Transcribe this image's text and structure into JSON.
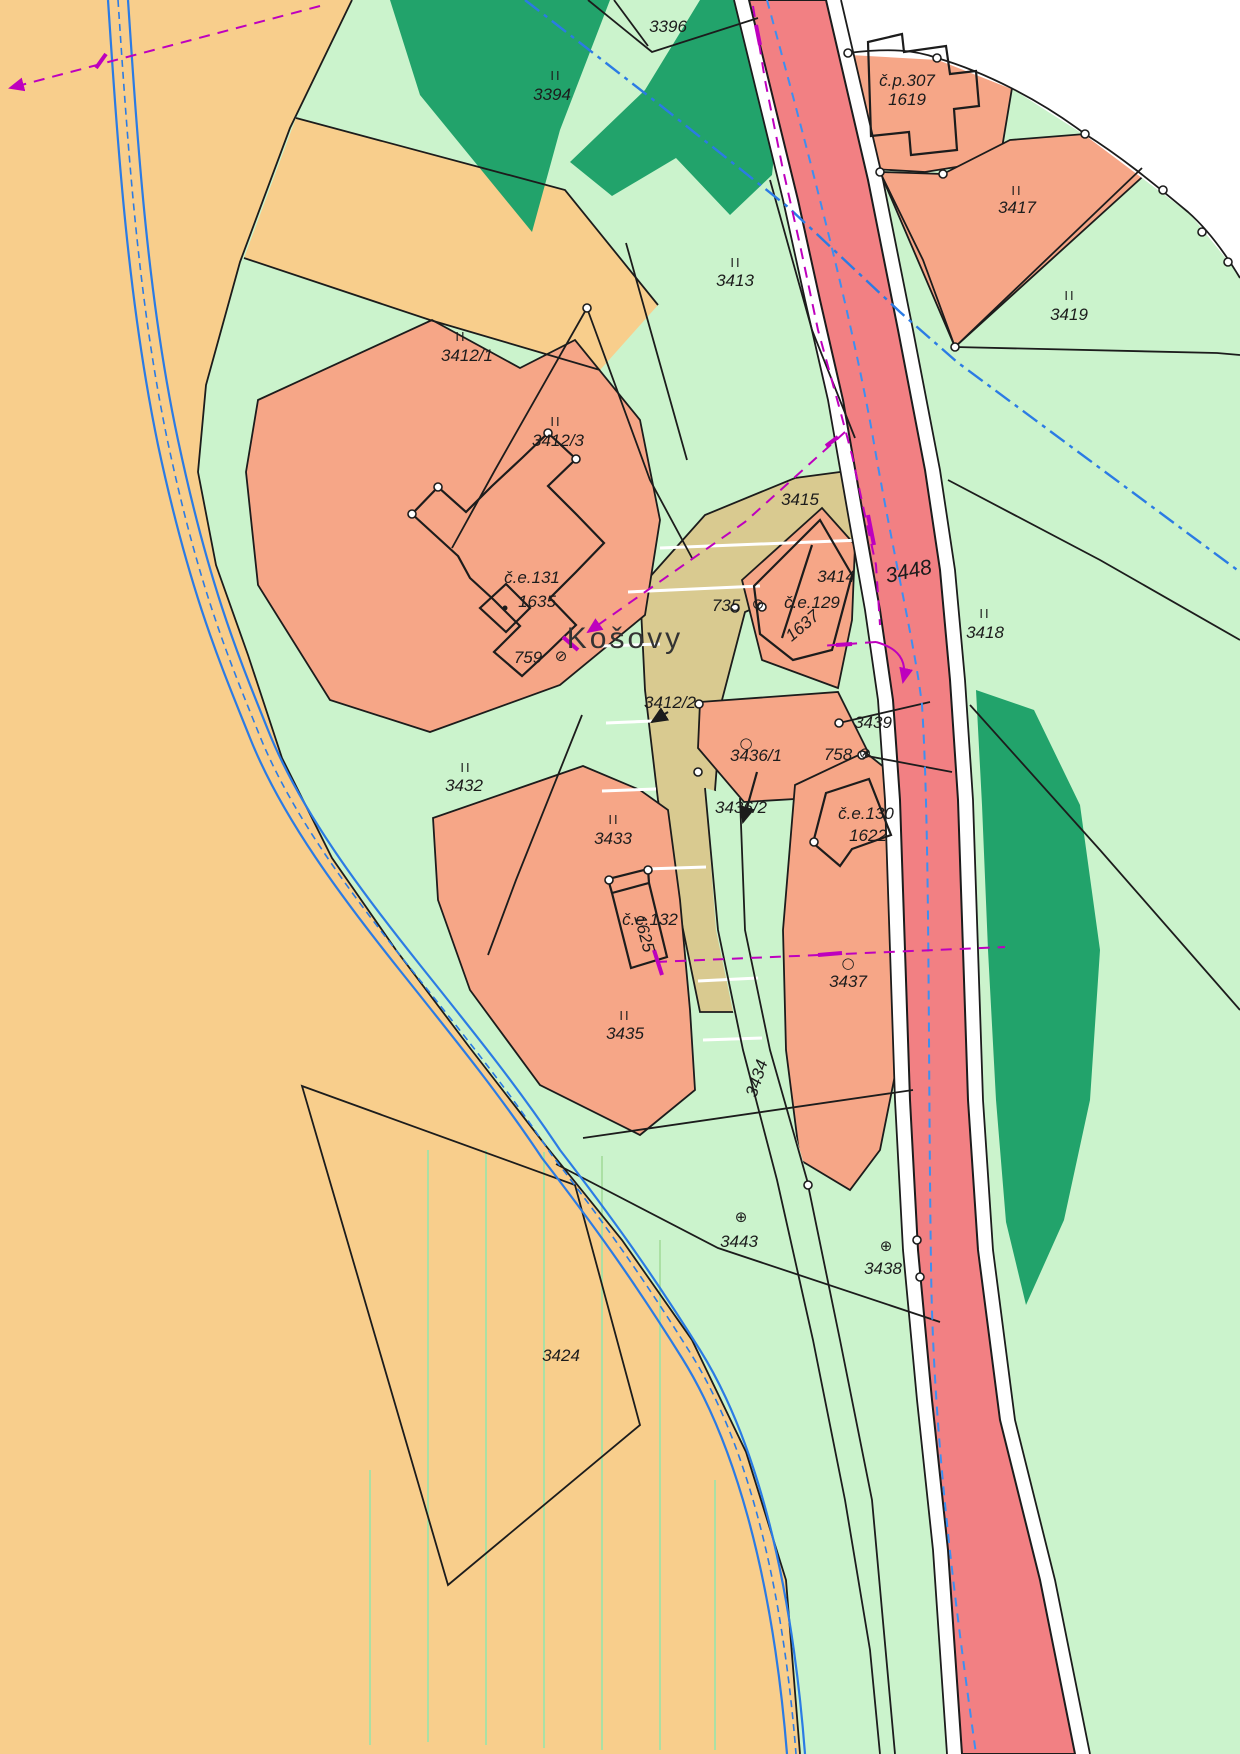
{
  "map": {
    "title": "Cadastral map",
    "place_name": "Košovy",
    "colors": {
      "field_orange": "#F8CE8C",
      "meadow_green": "#CBF3CC",
      "forest_green": "#22A36B",
      "built_salmon": "#F6A687",
      "road_red": "#F28083",
      "path_tan": "#D9CA90",
      "stream_blue": "#2B7BE4",
      "axis_blue": "#3E8FF0",
      "utility_magenta": "#BE00BE",
      "boundary_black": "#1c1c1c",
      "white": "#FFFFFF"
    },
    "labels": [
      {
        "name": "parcel-3396",
        "text": "3396",
        "x": 668,
        "y": 32,
        "cls": "num"
      },
      {
        "name": "class-ii-3394",
        "text": "II",
        "x": 556,
        "y": 80,
        "cls": "roman"
      },
      {
        "name": "parcel-3394",
        "text": "3394",
        "x": 552,
        "y": 100,
        "cls": "num"
      },
      {
        "name": "house-cp307",
        "text": "č.p.307",
        "x": 907,
        "y": 86,
        "cls": "num"
      },
      {
        "name": "parcel-1619",
        "text": "1619",
        "x": 907,
        "y": 105,
        "cls": "num"
      },
      {
        "name": "class-ii-3417",
        "text": "II",
        "x": 1017,
        "y": 195,
        "cls": "roman"
      },
      {
        "name": "parcel-3417",
        "text": "3417",
        "x": 1017,
        "y": 213,
        "cls": "num"
      },
      {
        "name": "class-ii-3419",
        "text": "II",
        "x": 1070,
        "y": 300,
        "cls": "roman"
      },
      {
        "name": "parcel-3419",
        "text": "3419",
        "x": 1069,
        "y": 320,
        "cls": "num"
      },
      {
        "name": "class-ii-3413",
        "text": "II",
        "x": 736,
        "y": 267,
        "cls": "roman"
      },
      {
        "name": "parcel-3413",
        "text": "3413",
        "x": 735,
        "y": 286,
        "cls": "num"
      },
      {
        "name": "class-ii-3412-1",
        "text": "II",
        "x": 461,
        "y": 341,
        "cls": "roman"
      },
      {
        "name": "parcel-3412-1",
        "text": "3412/1",
        "x": 467,
        "y": 361,
        "cls": "num"
      },
      {
        "name": "class-ii-3412-3",
        "text": "II",
        "x": 556,
        "y": 426,
        "cls": "roman"
      },
      {
        "name": "parcel-3412-3",
        "text": "3412/3",
        "x": 558,
        "y": 446,
        "cls": "num"
      },
      {
        "name": "parcel-3415",
        "text": "3415",
        "x": 800,
        "y": 505,
        "cls": "num"
      },
      {
        "name": "house-ce131",
        "text": "č.e.131",
        "x": 532,
        "y": 583,
        "cls": "num"
      },
      {
        "name": "parcel-1635",
        "text": "1635",
        "x": 537,
        "y": 607,
        "cls": "num"
      },
      {
        "name": "place-kosovy",
        "text": "Košovy",
        "x": 625,
        "y": 648,
        "cls": "place"
      },
      {
        "name": "parcel-759",
        "text": "759",
        "x": 528,
        "y": 663,
        "cls": "num"
      },
      {
        "name": "symbol-759",
        "text": "⊘",
        "x": 561,
        "y": 661,
        "cls": "sym"
      },
      {
        "name": "parcel-735",
        "text": "735",
        "x": 726,
        "y": 611,
        "cls": "num"
      },
      {
        "name": "symbol-735",
        "text": "⊘",
        "x": 758,
        "y": 609,
        "cls": "sym"
      },
      {
        "name": "parcel-3414",
        "text": "3414",
        "x": 836,
        "y": 582,
        "cls": "num"
      },
      {
        "name": "house-ce129",
        "text": "č.e.129",
        "x": 812,
        "y": 608,
        "cls": "num"
      },
      {
        "name": "parcel-1637",
        "text": "1637",
        "x": 806,
        "y": 630,
        "cls": "num",
        "rot": -40
      },
      {
        "name": "parcel-3448",
        "text": "3448",
        "x": 910,
        "y": 578,
        "cls": "num big",
        "rot": -12
      },
      {
        "name": "class-ii-3418",
        "text": "II",
        "x": 985,
        "y": 618,
        "cls": "roman"
      },
      {
        "name": "parcel-3418",
        "text": "3418",
        "x": 985,
        "y": 638,
        "cls": "num"
      },
      {
        "name": "parcel-3412-2",
        "text": "3412/2",
        "x": 670,
        "y": 708,
        "cls": "num"
      },
      {
        "name": "parcel-3439",
        "text": "3439",
        "x": 873,
        "y": 728,
        "cls": "num"
      },
      {
        "name": "symbol-3436-1",
        "text": "○",
        "x": 746,
        "y": 748,
        "cls": "sym"
      },
      {
        "name": "parcel-3436-1",
        "text": "3436/1",
        "x": 756,
        "y": 761,
        "cls": "num"
      },
      {
        "name": "parcel-758",
        "text": "758",
        "x": 838,
        "y": 760,
        "cls": "num"
      },
      {
        "name": "symbol-758",
        "text": "⊘",
        "x": 865,
        "y": 758,
        "cls": "sym"
      },
      {
        "name": "class-ii-3432",
        "text": "II",
        "x": 466,
        "y": 772,
        "cls": "roman"
      },
      {
        "name": "parcel-3432",
        "text": "3432",
        "x": 464,
        "y": 791,
        "cls": "num"
      },
      {
        "name": "parcel-3436-2",
        "text": "3436/2",
        "x": 741,
        "y": 813,
        "cls": "num"
      },
      {
        "name": "class-ii-3433",
        "text": "II",
        "x": 614,
        "y": 824,
        "cls": "roman"
      },
      {
        "name": "parcel-3433",
        "text": "3433",
        "x": 613,
        "y": 844,
        "cls": "num"
      },
      {
        "name": "house-ce130",
        "text": "č.e.130",
        "x": 866,
        "y": 819,
        "cls": "num"
      },
      {
        "name": "parcel-1622",
        "text": "1622",
        "x": 868,
        "y": 841,
        "cls": "num"
      },
      {
        "name": "house-ce132",
        "text": "č.e.132",
        "x": 650,
        "y": 925,
        "cls": "num"
      },
      {
        "name": "parcel-1625",
        "text": "1625",
        "x": 639,
        "y": 935,
        "cls": "num",
        "rot": 75
      },
      {
        "name": "symbol-3437",
        "text": "○",
        "x": 848,
        "y": 968,
        "cls": "sym"
      },
      {
        "name": "parcel-3437",
        "text": "3437",
        "x": 848,
        "y": 987,
        "cls": "num"
      },
      {
        "name": "class-ii-3435",
        "text": "II",
        "x": 625,
        "y": 1020,
        "cls": "roman"
      },
      {
        "name": "parcel-3435",
        "text": "3435",
        "x": 625,
        "y": 1039,
        "cls": "num"
      },
      {
        "name": "parcel-3434",
        "text": "3434",
        "x": 762,
        "y": 1080,
        "cls": "num",
        "rot": -72
      },
      {
        "name": "symbol-3443",
        "text": "⊕",
        "x": 741,
        "y": 1222,
        "cls": "sym"
      },
      {
        "name": "parcel-3443",
        "text": "3443",
        "x": 739,
        "y": 1247,
        "cls": "num"
      },
      {
        "name": "symbol-3438",
        "text": "⊕",
        "x": 886,
        "y": 1251,
        "cls": "sym"
      },
      {
        "name": "parcel-3438",
        "text": "3438",
        "x": 883,
        "y": 1274,
        "cls": "num"
      },
      {
        "name": "parcel-3424",
        "text": "3424",
        "x": 561,
        "y": 1361,
        "cls": "num"
      }
    ]
  }
}
